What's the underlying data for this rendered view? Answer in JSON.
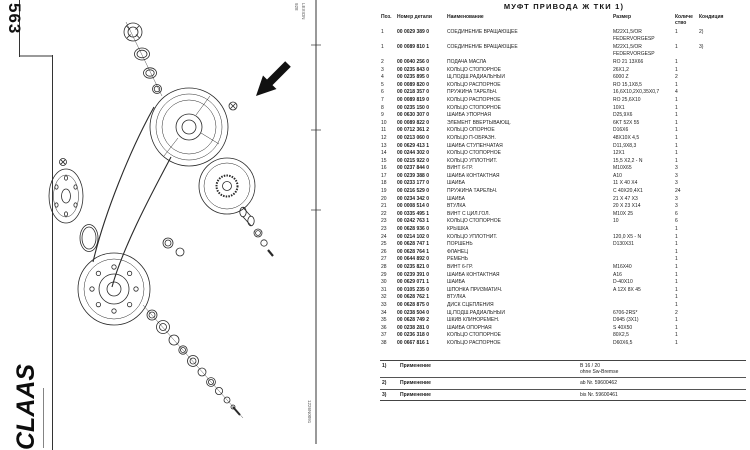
{
  "left": {
    "page_number": "563",
    "brand": "CLAAS",
    "edge_code_top": "928",
    "model_label": "LEXION",
    "drawing_code": "1226N0091"
  },
  "right": {
    "title": "МУФТ  ПРИВОДА Ж ТКИ  1)",
    "table": {
      "headers": {
        "pos": "Поз.",
        "part_number": "Номер детали",
        "name": "Наименование",
        "size": "Размер",
        "qty": "Количе\nство",
        "condition": "Кондиция"
      },
      "rows": [
        {
          "pos": "1",
          "pn": "00 0029 389 0",
          "name": "СОЕДИНЕНИЕ ВРАЩАЮЩЕЕ",
          "size": "M22X1,5/OR\nFEDERVORGESP",
          "qty": "1",
          "cond": "2)"
        },
        {
          "pos": "1",
          "pn": "00 0089 810 1",
          "name": "СОЕДИНЕНИЕ ВРАЩАЮЩЕЕ",
          "size": "M22X1,5/OR\nFEDERVORGESP",
          "qty": "1",
          "cond": "3)"
        },
        {
          "pos": "2",
          "pn": "00 0040 256 0",
          "name": "ПОДАЧА МАСЛА",
          "size": "RO 21 13X66",
          "qty": "1",
          "cond": ""
        },
        {
          "pos": "3",
          "pn": "00 0235 843 0",
          "name": "КОЛЬЦО СТОПОРНОЕ",
          "size": "26X1,2",
          "qty": "1",
          "cond": ""
        },
        {
          "pos": "4",
          "pn": "00 0235 895 0",
          "name": "Щ.ПОДШ.РАДИАЛЬНЫЙ",
          "size": "6000 Z",
          "qty": "2",
          "cond": ""
        },
        {
          "pos": "5",
          "pn": "00 0089 820 0",
          "name": "КОЛЬЦО РАСПОРНОЕ",
          "size": "RO 15,1X8,5",
          "qty": "1",
          "cond": ""
        },
        {
          "pos": "6",
          "pn": "00 0218 357 0",
          "name": "ПРУЖИНА ТАРЕЛЬЧ.",
          "size": "16,6X10,2X0,35X0,7",
          "qty": "4",
          "cond": ""
        },
        {
          "pos": "7",
          "pn": "00 0089 819 0",
          "name": "КОЛЬЦО РАСПОРНОЕ",
          "size": "RO 25,6X10",
          "qty": "1",
          "cond": ""
        },
        {
          "pos": "8",
          "pn": "00 0235 150 0",
          "name": "КОЛЬЦО СТОПОРНОЕ",
          "size": "10X1",
          "qty": "1",
          "cond": ""
        },
        {
          "pos": "9",
          "pn": "00 0630 307 0",
          "name": "ШАЙБА УПОРНАЯ",
          "size": "D25,9X6",
          "qty": "1",
          "cond": ""
        },
        {
          "pos": "10",
          "pn": "00 0089 822 0",
          "name": "ЭЛЕМЕНТ ВВЕРТЫВАЮЩ.",
          "size": "6KT 52X 55",
          "qty": "1",
          "cond": ""
        },
        {
          "pos": "11",
          "pn": "00 0712 361 2",
          "name": "КОЛЬЦО ОПОРНОЕ",
          "size": "D16X6",
          "qty": "1",
          "cond": ""
        },
        {
          "pos": "12",
          "pn": "00 0213 060 0",
          "name": "КОЛЬЦО П-ОБРАЗН.",
          "size": "48X10X 4,5",
          "qty": "1",
          "cond": ""
        },
        {
          "pos": "13",
          "pn": "00 0629 413 1",
          "name": "ШАЙБА СТУПЕНЧАТАЯ",
          "size": "D11,9X8,3",
          "qty": "1",
          "cond": ""
        },
        {
          "pos": "14",
          "pn": "00 0244 302 0",
          "name": "КОЛЬЦО СТОПОРНОЕ",
          "size": "12X1",
          "qty": "1",
          "cond": ""
        },
        {
          "pos": "15",
          "pn": "00 0215 922 0",
          "name": "КОЛЬЦО УПЛОТНИТ.",
          "size": "15,5 X2,2 - N",
          "qty": "1",
          "cond": ""
        },
        {
          "pos": "16",
          "pn": "00 0237 844 0",
          "name": "ВИНТ 6-ГР.",
          "size": "M10X65",
          "qty": "3",
          "cond": ""
        },
        {
          "pos": "17",
          "pn": "00 0239 388 0",
          "name": "ШАЙБА КОНТАКТНАЯ",
          "size": "A10",
          "qty": "3",
          "cond": ""
        },
        {
          "pos": "18",
          "pn": "00 0233 177 0",
          "name": "ШАЙБА",
          "size": "11 X 40 X4",
          "qty": "3",
          "cond": ""
        },
        {
          "pos": "19",
          "pn": "00 0216 529 0",
          "name": "ПРУЖИНА ТАРЕЛЬЧ.",
          "size": "C 40X20,4X1",
          "qty": "24",
          "cond": ""
        },
        {
          "pos": "20",
          "pn": "00 0234 342 0",
          "name": "ШАЙБА",
          "size": "21 X 47 X3",
          "qty": "3",
          "cond": ""
        },
        {
          "pos": "21",
          "pn": "00 0008 514 0",
          "name": "ВТУЛКА",
          "size": "20 X 23 X14",
          "qty": "3",
          "cond": ""
        },
        {
          "pos": "22",
          "pn": "00 0335 495 1",
          "name": "ВИНТ С ЦИЛ.ГОЛ.",
          "size": "M10X 25",
          "qty": "6",
          "cond": ""
        },
        {
          "pos": "23",
          "pn": "00 0242 763 1",
          "name": "КОЛЬЦО СТОПОРНОЕ",
          "size": "10",
          "qty": "6",
          "cond": ""
        },
        {
          "pos": "23",
          "pn": "00 0628 936 0",
          "name": "КРЫШКА",
          "size": "",
          "qty": "1",
          "cond": ""
        },
        {
          "pos": "24",
          "pn": "00 0214 102 0",
          "name": "КОЛЬЦО УПЛОТНИТ.",
          "size": "120,0 X5 - N",
          "qty": "1",
          "cond": ""
        },
        {
          "pos": "25",
          "pn": "00 0628 747 1",
          "name": "ПОРШЕНЬ",
          "size": "D130X31",
          "qty": "1",
          "cond": ""
        },
        {
          "pos": "26",
          "pn": "00 0628 764 1",
          "name": "ФЛАНЕЦ",
          "size": "",
          "qty": "1",
          "cond": ""
        },
        {
          "pos": "27",
          "pn": "00 0644 892 0",
          "name": "РЕМЕНЬ",
          "size": "",
          "qty": "1",
          "cond": ""
        },
        {
          "pos": "28",
          "pn": "00 0235 821 0",
          "name": "ВИНТ 6-ГР.",
          "size": "M16X40",
          "qty": "1",
          "cond": ""
        },
        {
          "pos": "29",
          "pn": "00 0239 391 0",
          "name": "ШАЙБА КОНТАКТНАЯ",
          "size": "A16",
          "qty": "1",
          "cond": ""
        },
        {
          "pos": "30",
          "pn": "00 0629 071 1",
          "name": "ШАЙБА",
          "size": "D-40X10",
          "qty": "1",
          "cond": ""
        },
        {
          "pos": "31",
          "pn": "00 0105 235 0",
          "name": "ШПОНКА ПРИЗМАТИЧ.",
          "size": "A 12X 8X 45",
          "qty": "1",
          "cond": ""
        },
        {
          "pos": "32",
          "pn": "00 0628 762 1",
          "name": "ВТУЛКА",
          "size": "",
          "qty": "1",
          "cond": ""
        },
        {
          "pos": "33",
          "pn": "00 0628 875 0",
          "name": "ДИСК СЦЕПЛЕНИЯ",
          "size": "",
          "qty": "1",
          "cond": ""
        },
        {
          "pos": "34",
          "pn": "00 0238 504 0",
          "name": "Щ.ПОДШ.РАДИАЛЬНЫЙ",
          "size": "6706-2RS*",
          "qty": "2",
          "cond": ""
        },
        {
          "pos": "35",
          "pn": "00 0628 749 2",
          "name": "ШКИВ КЛИНОРЕМЕН.",
          "size": "D945 (3X1)",
          "qty": "1",
          "cond": ""
        },
        {
          "pos": "36",
          "pn": "00 0238 281 0",
          "name": "ШАЙБА ОПОРНАЯ",
          "size": "S 40X50",
          "qty": "1",
          "cond": ""
        },
        {
          "pos": "37",
          "pn": "00 0236 318 0",
          "name": "КОЛЬЦО СТОПОРНОЕ",
          "size": "80X2,5",
          "qty": "1",
          "cond": ""
        },
        {
          "pos": "38",
          "pn": "00 0667 816 1",
          "name": "КОЛЬЦО РАСПОРНОЕ",
          "size": "D60X6,5",
          "qty": "1",
          "cond": ""
        }
      ]
    },
    "notes": [
      {
        "ref": "1)",
        "label": "Применение",
        "value": "B 16 / 20\nohne Sw-Bremse"
      },
      {
        "ref": "2)",
        "label": "Применение",
        "value": "ab Nr. 59600462"
      },
      {
        "ref": "3)",
        "label": "Применение",
        "value": "bis Nr. 59600461"
      }
    ]
  }
}
